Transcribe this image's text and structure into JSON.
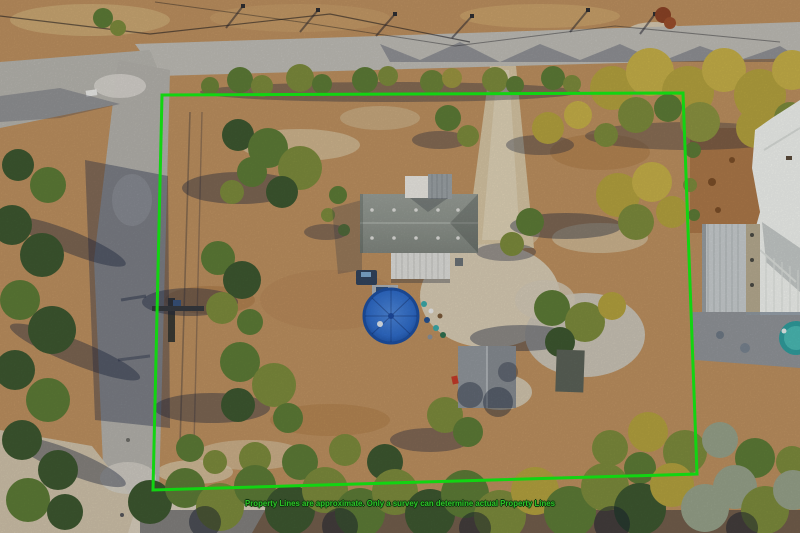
{
  "image_type": "aerial-drone-photo-of-property",
  "overlay": {
    "disclaimer": "Property Lines are approximate. Only a survey can determine actual Property Lines",
    "text_color": "#2bc427",
    "outline_color": "#10350e"
  },
  "property_line": {
    "color": "#12d412",
    "stroke_width": "3",
    "points": "162,95 683,93 697,474 153,490"
  },
  "scene": {
    "description": "Aerial view of a rural lot with a gray-roofed house, round blue above-ground pool, shed, sandy driveway, scattered autumn trees, roads on the north and west sides, and a neighboring white-roofed house with metal barn and small teal pool at the east edge",
    "colors": {
      "field_tan": "#bb8f5f",
      "road_gray": "#bdbbb5",
      "house_roof": "#8d938c",
      "porch_roof": "#dcdcd8",
      "pool_blue": "#2e6ac6",
      "neighbor_roof": "#eef0ec",
      "barn_gray": "#c6cbcd",
      "neighbor_pool_teal": "#2f9c9c",
      "tree_green": "#5c7a36",
      "tree_yellow": "#b2a03e"
    }
  }
}
